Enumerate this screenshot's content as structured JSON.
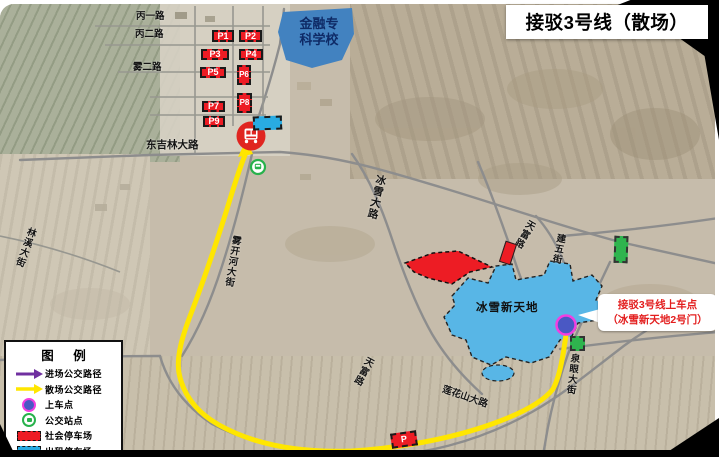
{
  "title": "接驳3号线（散场）",
  "legend": {
    "title": "图 例",
    "items": [
      {
        "label": "进场公交路径",
        "type": "arrow",
        "color": "#7030a0"
      },
      {
        "label": "散场公交路径",
        "type": "arrow",
        "color": "#ffe600"
      },
      {
        "label": "上车点",
        "type": "boarding-circle",
        "color": "#4a58c4"
      },
      {
        "label": "公交站点",
        "type": "bus-stop",
        "color": "#28b24c"
      },
      {
        "label": "社会停车场",
        "type": "dashed-box",
        "color": "#ed1c24"
      },
      {
        "label": "出租停车场",
        "type": "dashed-box",
        "color": "#29abe2"
      }
    ]
  },
  "map": {
    "school": {
      "line1": "金融专",
      "line2": "科学校"
    },
    "venue": "冰雪新天地",
    "callout": {
      "line1": "接驳3号线上车点",
      "line2": "（冰雪新天地2号门）"
    },
    "roads": [
      "丙一路",
      "丙二路",
      "雾二路",
      "东吉林大路",
      "冰雪大路",
      "天富路",
      "建五街",
      "天富路",
      "莲花山大路",
      "泉眼大街",
      "林溪大街",
      "雾开河大街"
    ],
    "parking": [
      "P1",
      "P2",
      "P3",
      "P4",
      "P5",
      "P6",
      "P7",
      "P8",
      "P9",
      "P"
    ]
  },
  "colors": {
    "route_exit_yellow": "#ffe600",
    "route_enter_purple": "#7030a0",
    "parking_public_red": "#ed1c24",
    "parking_taxi_blue": "#29abe2",
    "boarding_point_fill": "#4a58c4",
    "boarding_point_ring": "#f23ee0",
    "bus_stop_green": "#28b24c",
    "bus_terminal_red": "#e02520",
    "school_fill": "#4282c0",
    "venue_fill": "#58b6e6"
  }
}
